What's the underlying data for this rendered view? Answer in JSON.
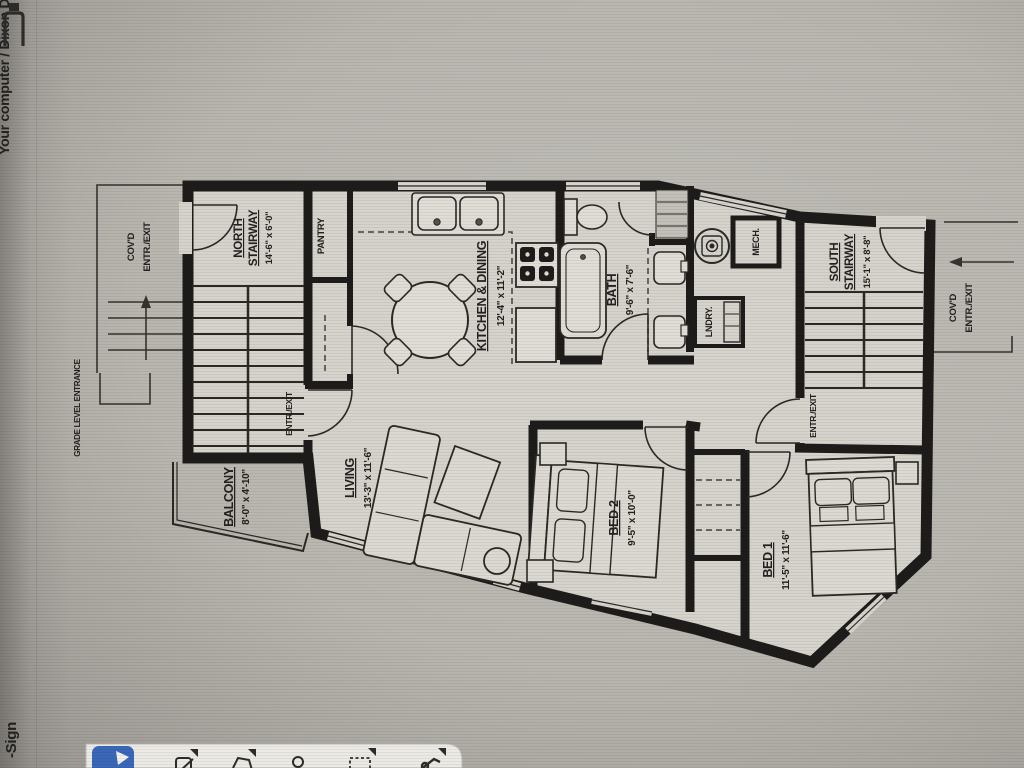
{
  "chrome": {
    "top_edge_text": "Your computer  /  Dixon Dailey",
    "side_bottom_text": "-Sign",
    "toolbar_icon_names": [
      "app-flag-icon",
      "crop-tool-icon",
      "polygon-tool-icon",
      "person-tool-icon",
      "selection-tool-icon",
      "pen-tool-icon"
    ]
  },
  "floorplan": {
    "rooms": {
      "north_stairway": {
        "line1": "NORTH",
        "line2": "STAIRWAY",
        "dims": "14'-6\" x 6'-0\""
      },
      "south_stairway": {
        "line1": "SOUTH",
        "line2": "STAIRWAY",
        "dims": "15'-1\" x 8'-8\""
      },
      "kitchen_dining": {
        "name": "KITCHEN & DINING",
        "dims": "12'-4\" x 11'-2\""
      },
      "bath": {
        "name": "BATH",
        "dims": "9'-6\" x 7'-6\""
      },
      "living": {
        "name": "LIVING",
        "dims": "13'-3\" x 11'-6\""
      },
      "balcony": {
        "name": "BALCONY",
        "dims": "8'-0\" x 4'-10\""
      },
      "bed1": {
        "name": "BED 1",
        "dims": "11'-5\" x 11'-6\""
      },
      "bed2": {
        "name": "BED 2",
        "dims": "9'-5\" x 10'-0\""
      }
    },
    "labels": {
      "pantry": "PANTRY",
      "mech": "MECH.",
      "lndry": "LNDRY.",
      "entr_exit": "ENTR./EXIT",
      "covd_line1": "COV'D",
      "covd_line2": "ENTR./EXIT",
      "grade_level": "GRADE LEVEL ENTRANCE"
    }
  },
  "colors": {
    "screen_bg": "#b9b6b0",
    "plan_fill": "#d6d3cc",
    "wall": "#1e1c1a",
    "toolbar_bg": "#eceae5",
    "accent_blue": "#3a67b8"
  }
}
